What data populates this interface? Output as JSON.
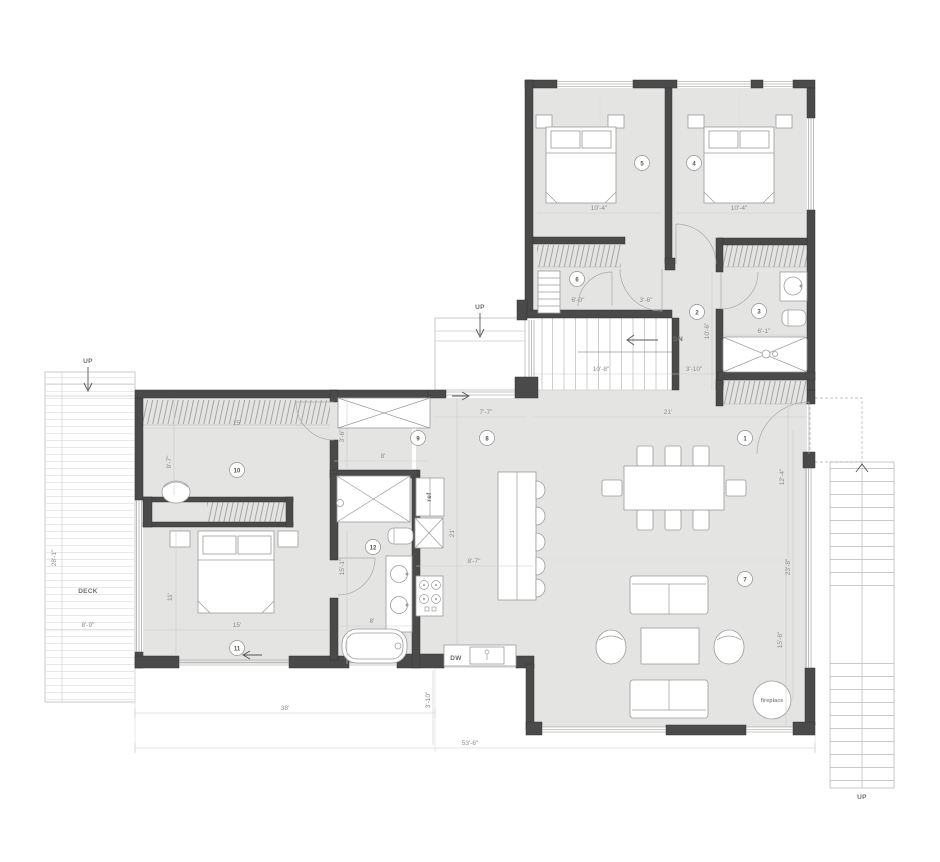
{
  "plan": {
    "rooms": [
      "1",
      "2",
      "3",
      "4",
      "5",
      "6",
      "7",
      "8",
      "9",
      "10",
      "11",
      "12"
    ],
    "labels": {
      "deck": "DECK",
      "up": "UP",
      "dn": "DN",
      "dw": "DW",
      "ref": "ref",
      "fireplace": "fireplace"
    },
    "dims": {
      "bed5": "10'-4\"",
      "bed4": "10'-4\"",
      "closet6": "6'-0\"",
      "hall_door": "3'-6\"",
      "bath3_w": "6'-1\"",
      "bath3_h": "10'-6\"",
      "stair": "10'-8\"",
      "hall_w": "3'-10\"",
      "dining_w": "21'",
      "entry_w": "7'-7\"",
      "dining_h": "12'-4\"",
      "window_h": "23'-8\"",
      "living_h": "15'-6\"",
      "r10_w": "15'",
      "r10_h": "9'-7\"",
      "r9_w": "8'",
      "r9_h": "3'-6\"",
      "r11_h": "11'",
      "r11_w": "15'",
      "bath12_h": "15'-1\"",
      "bath12_w": "8'",
      "kitchen_w": "8'-7\"",
      "kitchen_h": "21'",
      "deck_h": "28'-1\"",
      "deck_w": "8'-9\"",
      "wing_w": "38'",
      "total_w": "53'-6\"",
      "kitchen_off": "3'-10\""
    }
  }
}
